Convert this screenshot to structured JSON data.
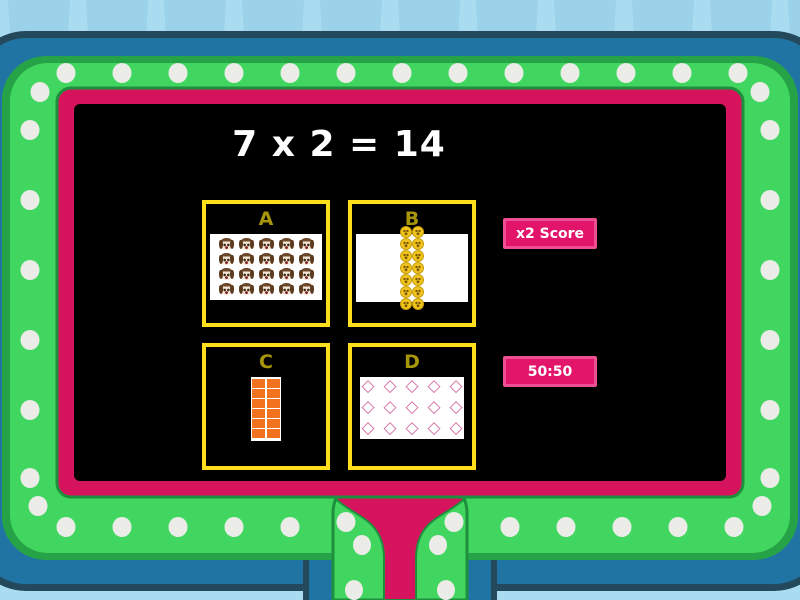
{
  "question": {
    "text": "7 x 2 = 14"
  },
  "options": [
    {
      "letter": "A",
      "item": "dog-face-emoji",
      "rows": 4,
      "cols": 5,
      "count": 20
    },
    {
      "letter": "B",
      "item": "smiley-emoji",
      "rows": 7,
      "cols": 2,
      "count": 14
    },
    {
      "letter": "C",
      "item": "orange-square",
      "rows": 6,
      "cols": 2,
      "count": 12
    },
    {
      "letter": "D",
      "item": "diamond-outline",
      "rows": 3,
      "cols": 5,
      "count": 15
    }
  ],
  "powerups": [
    {
      "label": "x2 Score"
    },
    {
      "label": "50:50"
    }
  ],
  "glyphs": {
    "diamond-outline": "◇"
  },
  "colors": {
    "background": "#a9dcf1",
    "background_stripe": "#9bd2ea",
    "frame_navy": "#24485c",
    "frame_blue": "#1f74a3",
    "frame_green_bright": "#41d65f",
    "frame_green_dark": "#27a347",
    "frame_pink": "#d6145e",
    "screen_black": "#000000",
    "marquee_dot": "#ebebe8",
    "option_border_yellow": "#ffdf1b",
    "option_letter_gold": "#a7950a",
    "button_pink": "#e2156b",
    "button_border": "#ee4e92",
    "question_text": "#ffffff"
  }
}
